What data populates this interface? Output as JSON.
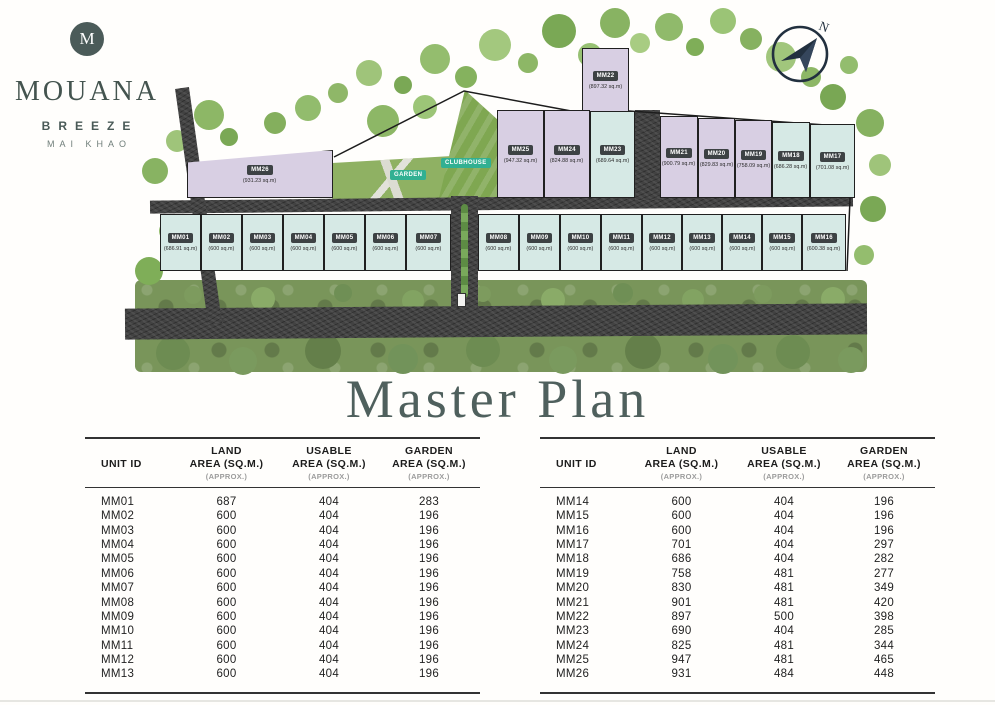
{
  "brand": {
    "monogram": "M",
    "name": "MOUANA",
    "subtitle": "BREEZE",
    "location": "MAI KHAO"
  },
  "title": "Master Plan",
  "site_plan": {
    "compass_label": "N",
    "garden_label": "GARDEN",
    "clubhouse_label": "CLUBHOUSE",
    "lot_colors": {
      "lavender": "#d8cfe3",
      "teal": "#d6e9e5"
    },
    "lots": [
      {
        "id": "MM01",
        "area": "(686.91 sq.m)",
        "color": "teal",
        "x": 40,
        "y": 214,
        "w": 41,
        "h": 57
      },
      {
        "id": "MM02",
        "area": "(600 sq.m)",
        "color": "teal",
        "x": 81,
        "y": 214,
        "w": 41,
        "h": 57
      },
      {
        "id": "MM03",
        "area": "(600 sq.m)",
        "color": "teal",
        "x": 122,
        "y": 214,
        "w": 41,
        "h": 57
      },
      {
        "id": "MM04",
        "area": "(600 sq.m)",
        "color": "teal",
        "x": 163,
        "y": 214,
        "w": 41,
        "h": 57
      },
      {
        "id": "MM05",
        "area": "(600 sq.m)",
        "color": "teal",
        "x": 204,
        "y": 214,
        "w": 41,
        "h": 57
      },
      {
        "id": "MM06",
        "area": "(600 sq.m)",
        "color": "teal",
        "x": 245,
        "y": 214,
        "w": 41,
        "h": 57
      },
      {
        "id": "MM07",
        "area": "(600 sq.m)",
        "color": "teal",
        "x": 286,
        "y": 214,
        "w": 45,
        "h": 57
      },
      {
        "id": "MM08",
        "area": "(600 sq.m)",
        "color": "teal",
        "x": 358,
        "y": 214,
        "w": 41,
        "h": 57
      },
      {
        "id": "MM09",
        "area": "(600 sq.m)",
        "color": "teal",
        "x": 399,
        "y": 214,
        "w": 41,
        "h": 57
      },
      {
        "id": "MM10",
        "area": "(600 sq.m)",
        "color": "teal",
        "x": 440,
        "y": 214,
        "w": 41,
        "h": 57
      },
      {
        "id": "MM11",
        "area": "(600 sq.m)",
        "color": "teal",
        "x": 481,
        "y": 214,
        "w": 41,
        "h": 57
      },
      {
        "id": "MM12",
        "area": "(600 sq.m)",
        "color": "teal",
        "x": 522,
        "y": 214,
        "w": 40,
        "h": 57
      },
      {
        "id": "MM13",
        "area": "(600 sq.m)",
        "color": "teal",
        "x": 562,
        "y": 214,
        "w": 40,
        "h": 57
      },
      {
        "id": "MM14",
        "area": "(600 sq.m)",
        "color": "teal",
        "x": 602,
        "y": 214,
        "w": 40,
        "h": 57
      },
      {
        "id": "MM15",
        "area": "(600 sq.m)",
        "color": "teal",
        "x": 642,
        "y": 214,
        "w": 40,
        "h": 57
      },
      {
        "id": "MM16",
        "area": "(600.38 sq.m)",
        "color": "teal",
        "x": 682,
        "y": 214,
        "w": 44,
        "h": 57
      },
      {
        "id": "MM17",
        "area": "(701.08 sq.m)",
        "color": "teal",
        "x": 690,
        "y": 124,
        "w": 45,
        "h": 74
      },
      {
        "id": "MM18",
        "area": "(686.28 sq.m)",
        "color": "teal",
        "x": 652,
        "y": 122,
        "w": 38,
        "h": 76
      },
      {
        "id": "MM19",
        "area": "(758.09 sq.m)",
        "color": "lavender",
        "x": 615,
        "y": 120,
        "w": 37,
        "h": 78
      },
      {
        "id": "MM20",
        "area": "(829.83 sq.m)",
        "color": "lavender",
        "x": 578,
        "y": 118,
        "w": 37,
        "h": 80
      },
      {
        "id": "MM21",
        "area": "(900.79 sq.m)",
        "color": "lavender",
        "x": 540,
        "y": 116,
        "w": 38,
        "h": 82
      },
      {
        "id": "MM22",
        "area": "(897.32 sq.m)",
        "color": "lavender",
        "x": 462,
        "y": 48,
        "w": 47,
        "h": 64
      },
      {
        "id": "MM23",
        "area": "(689.64 sq.m)",
        "color": "teal",
        "x": 470,
        "y": 111,
        "w": 45,
        "h": 87
      },
      {
        "id": "MM24",
        "area": "(824.88 sq.m)",
        "color": "lavender",
        "x": 424,
        "y": 110,
        "w": 46,
        "h": 88
      },
      {
        "id": "MM25",
        "area": "(947.32 sq.m)",
        "color": "lavender",
        "x": 377,
        "y": 110,
        "w": 47,
        "h": 88
      },
      {
        "id": "MM26",
        "area": "(931.23 sq.m)",
        "color": "lavender",
        "x": 67,
        "y": 150,
        "w": 146,
        "h": 48,
        "clip": "polygon(0 26%, 100% 0, 100% 100%, 0 100%)"
      }
    ]
  },
  "table_columns": [
    {
      "l1": "",
      "l2": "UNIT ID",
      "l3": ""
    },
    {
      "l1": "LAND",
      "l2": "AREA (SQ.M.)",
      "l3": "(APPROX.)"
    },
    {
      "l1": "USABLE",
      "l2": "AREA (SQ.M.)",
      "l3": "(APPROX.)"
    },
    {
      "l1": "GARDEN",
      "l2": "AREA (SQ.M.)",
      "l3": "(APPROX.)"
    }
  ],
  "tables": [
    {
      "rows": [
        [
          "MM01",
          "687",
          "404",
          "283"
        ],
        [
          "MM02",
          "600",
          "404",
          "196"
        ],
        [
          "MM03",
          "600",
          "404",
          "196"
        ],
        [
          "MM04",
          "600",
          "404",
          "196"
        ],
        [
          "MM05",
          "600",
          "404",
          "196"
        ],
        [
          "MM06",
          "600",
          "404",
          "196"
        ],
        [
          "MM07",
          "600",
          "404",
          "196"
        ],
        [
          "MM08",
          "600",
          "404",
          "196"
        ],
        [
          "MM09",
          "600",
          "404",
          "196"
        ],
        [
          "MM10",
          "600",
          "404",
          "196"
        ],
        [
          "MM11",
          "600",
          "404",
          "196"
        ],
        [
          "MM12",
          "600",
          "404",
          "196"
        ],
        [
          "MM13",
          "600",
          "404",
          "196"
        ]
      ]
    },
    {
      "rows": [
        [
          "MM14",
          "600",
          "404",
          "196"
        ],
        [
          "MM15",
          "600",
          "404",
          "196"
        ],
        [
          "MM16",
          "600",
          "404",
          "196"
        ],
        [
          "MM17",
          "701",
          "404",
          "297"
        ],
        [
          "MM18",
          "686",
          "404",
          "282"
        ],
        [
          "MM19",
          "758",
          "481",
          "277"
        ],
        [
          "MM20",
          "830",
          "481",
          "349"
        ],
        [
          "MM21",
          "901",
          "481",
          "420"
        ],
        [
          "MM22",
          "897",
          "500",
          "398"
        ],
        [
          "MM23",
          "690",
          "404",
          "285"
        ],
        [
          "MM24",
          "825",
          "481",
          "344"
        ],
        [
          "MM25",
          "947",
          "481",
          "465"
        ],
        [
          "MM26",
          "931",
          "484",
          "448"
        ]
      ]
    }
  ]
}
